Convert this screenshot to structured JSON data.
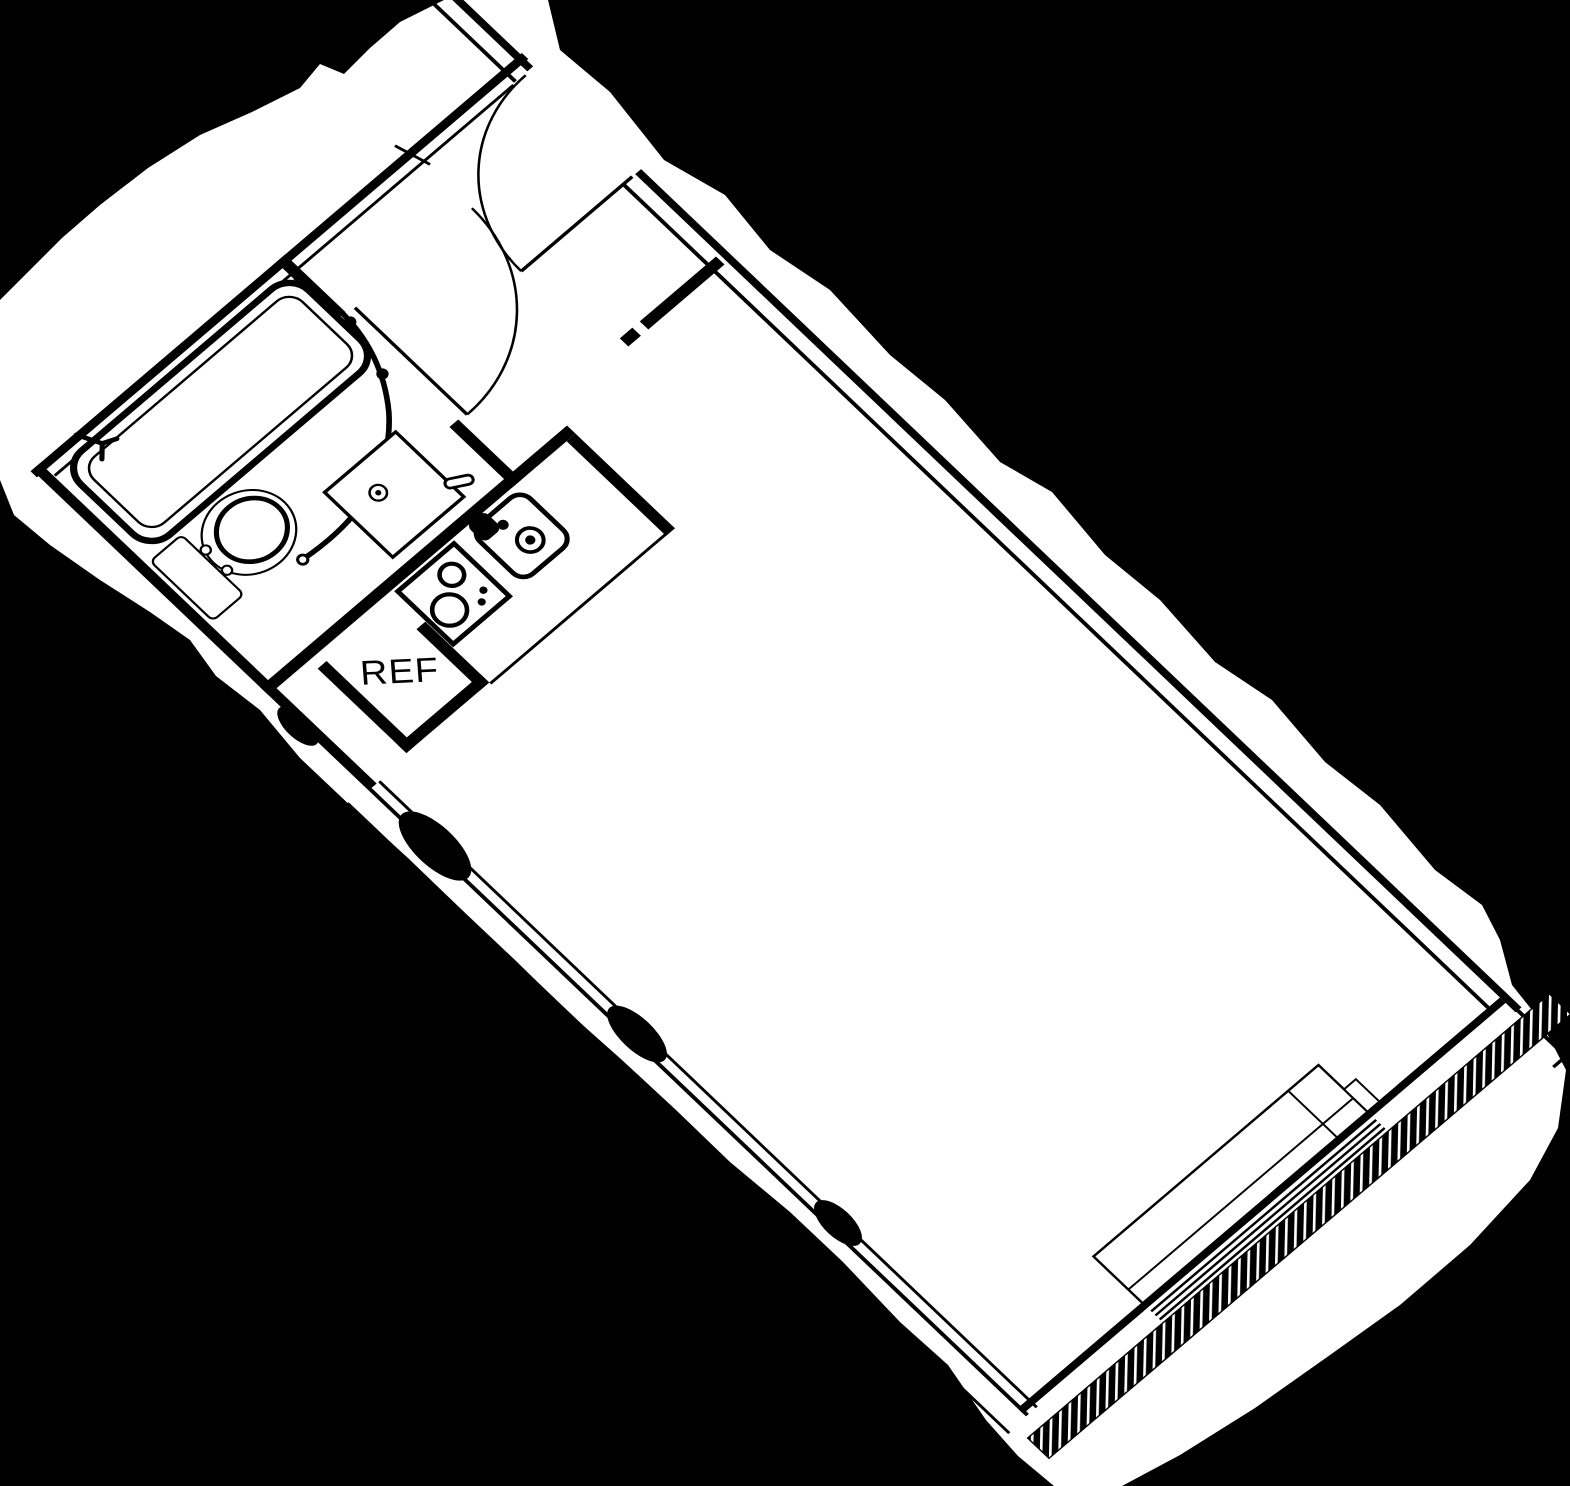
{
  "document": {
    "type": "scanned-floor-plan",
    "background_color": "#000000",
    "paper_color": "#ffffff",
    "line_color": "#000000"
  },
  "labels": {
    "refrigerator": "REF"
  },
  "fixtures": [
    "bathtub",
    "shower-curtain",
    "toilet",
    "vanity-sink",
    "bathroom-door",
    "entry-door",
    "refrigerator-nook",
    "cooktop",
    "kitchen-sink",
    "window",
    "hatched-exterior-wall"
  ]
}
